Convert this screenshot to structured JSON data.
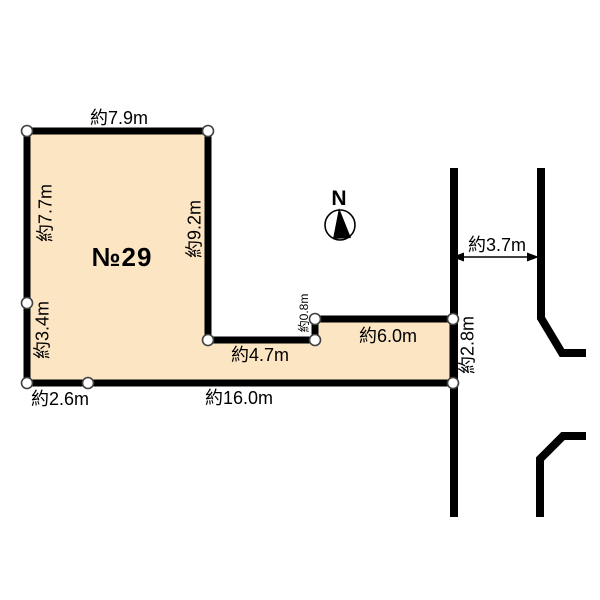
{
  "diagram": {
    "type_hint": "land-plot-survey-diagram",
    "colors": {
      "plot_fill": "#FCE5C2",
      "line": "#000000",
      "background": "#FFFFFF",
      "vertex_fill": "#FFFFFF",
      "vertex_stroke": "#404040"
    },
    "plot": {
      "number": "№29",
      "dimensions": {
        "top": "約7.9m",
        "left_upper": "約7.7m",
        "left_lower": "約3.4m",
        "inner_vertical": "約9.2m",
        "inner_horizontal": "約4.7m",
        "step": "約0.8m",
        "right_upper": "約6.0m",
        "right_edge": "約2.8m",
        "bottom_left": "約2.6m",
        "bottom": "約16.0m"
      }
    },
    "road": {
      "width": "約3.7m"
    },
    "compass": {
      "north": "N"
    }
  }
}
